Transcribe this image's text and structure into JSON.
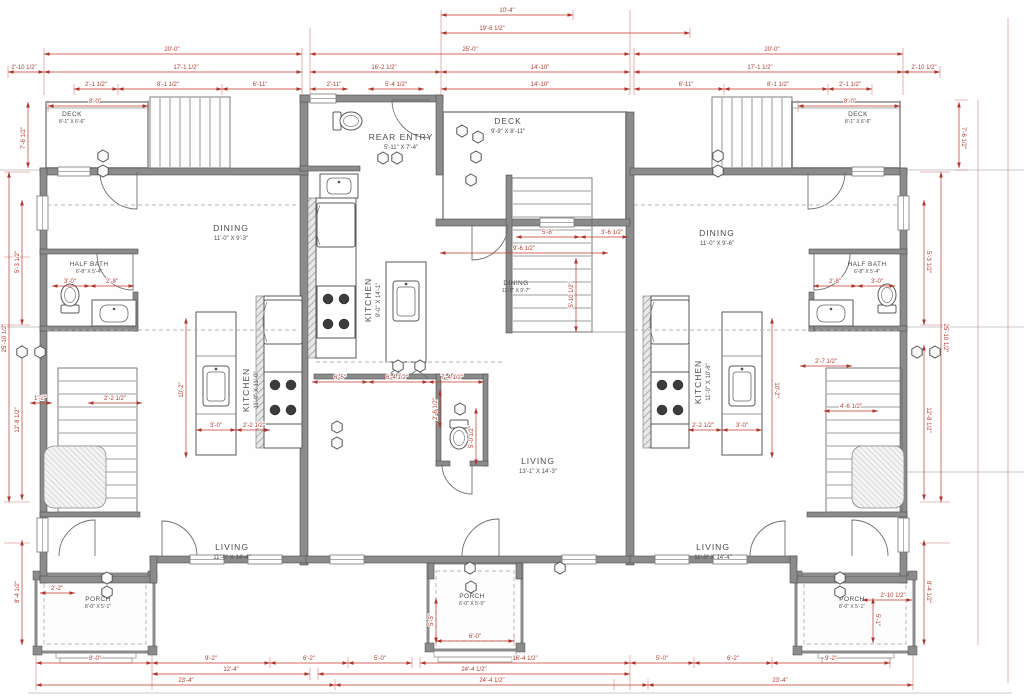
{
  "drawing": {
    "type": "architectural floor plan - triplex main level",
    "colors": {
      "dimension_red": "#c0392b",
      "wall_gray": "#8b8b8b",
      "label_gray": "#4d4d4d",
      "background": "#fefefe"
    }
  },
  "rooms": [
    {
      "id": "left-deck",
      "label": "DECK",
      "size": "8'-1\" X 6'-6\"",
      "x": 72,
      "y": 116,
      "small": true
    },
    {
      "id": "left-dining",
      "label": "DINING",
      "size": "11'-0\" X 9'-3\"",
      "x": 231,
      "y": 231
    },
    {
      "id": "left-kitchen",
      "label": "KITCHEN",
      "size": "11'-0\" X 11'-0\"",
      "x": 249,
      "y": 390,
      "r": -90
    },
    {
      "id": "left-halfbath",
      "label": "HALF BATH",
      "size": "6'-8\" X 5'-4\"",
      "x": 89,
      "y": 266,
      "small": true
    },
    {
      "id": "left-living",
      "label": "LIVING",
      "size": "11'-0\" X 14'-4\"",
      "x": 232,
      "y": 550
    },
    {
      "id": "left-porch",
      "label": "PORCH",
      "size": "8'-0\" X 5'-1\"",
      "x": 98,
      "y": 601,
      "small": true
    },
    {
      "id": "rear-entry",
      "label": "REAR ENTRY",
      "size": "5'-11\" X 7'-4\"",
      "x": 401,
      "y": 140
    },
    {
      "id": "mid-deck",
      "label": "DECK",
      "size": "9'-9\" X 8'-11\"",
      "x": 508,
      "y": 124
    },
    {
      "id": "mid-dining",
      "label": "DINING",
      "size": "11'-5\" X 9'-7\"",
      "x": 516,
      "y": 285,
      "small": true
    },
    {
      "id": "mid-kitchen",
      "label": "KITCHEN",
      "size": "9'-0\" X 14'-1\"",
      "x": 371,
      "y": 300,
      "r": -90
    },
    {
      "id": "mid-living",
      "label": "LIVING",
      "size": "13'-1\" X 14'-3\"",
      "x": 538,
      "y": 464
    },
    {
      "id": "mid-porch",
      "label": "PORCH",
      "size": "6'-0\" X 5'-5\"",
      "x": 472,
      "y": 598,
      "small": true
    },
    {
      "id": "right-dining",
      "label": "DINING",
      "size": "11'-0\" X 9'-6\"",
      "x": 717,
      "y": 236
    },
    {
      "id": "right-kitchen",
      "label": "KITCHEN",
      "size": "11'-0\" X 10'-8\"",
      "x": 701,
      "y": 382,
      "r": -90
    },
    {
      "id": "right-halfbath",
      "label": "HALF BATH",
      "size": "6'-8\" X 5'-4\"",
      "x": 867,
      "y": 266,
      "small": true
    },
    {
      "id": "right-living",
      "label": "LIVING",
      "size": "11'-0\" X 14'-4\"",
      "x": 713,
      "y": 550
    },
    {
      "id": "right-porch",
      "label": "PORCH",
      "size": "8'-0\" X 5'-1\"",
      "x": 852,
      "y": 601,
      "small": true
    },
    {
      "id": "right-deck",
      "label": "DECK",
      "size": "8'-1\" X 6'-6\"",
      "x": 858,
      "y": 116,
      "small": true
    }
  ],
  "dimensions": [
    {
      "t": "10'-4\"",
      "x": 507,
      "y": 12,
      "l": [
        441,
        15,
        573,
        15
      ]
    },
    {
      "t": "19'-6 1/2\"",
      "x": 492,
      "y": 30,
      "l": [
        441,
        33,
        690,
        33
      ]
    },
    {
      "t": "25'-0\"",
      "x": 470,
      "y": 51,
      "l": [
        310,
        54,
        630,
        54
      ]
    },
    {
      "t": "20'-0\"",
      "x": 172,
      "y": 51,
      "l": [
        44,
        54,
        302,
        54
      ]
    },
    {
      "t": "20'-0\"",
      "x": 772,
      "y": 51,
      "l": [
        634,
        54,
        903,
        54
      ]
    },
    {
      "t": "2'-10 1/2\"",
      "x": 24,
      "y": 69,
      "l": [
        8,
        72,
        44,
        72
      ]
    },
    {
      "t": "17'-1 1/2\"",
      "x": 186,
      "y": 69,
      "l": [
        44,
        72,
        302,
        72
      ]
    },
    {
      "t": "17'-1 1/2\"",
      "x": 760,
      "y": 69,
      "l": [
        634,
        72,
        903,
        72
      ]
    },
    {
      "t": "2'-10 1/2\"",
      "x": 924,
      "y": 69,
      "l": [
        903,
        72,
        940,
        72
      ]
    },
    {
      "t": "16'-2 1/2\"",
      "x": 384,
      "y": 69,
      "l": [
        310,
        72,
        441,
        72
      ]
    },
    {
      "t": "14'-10\"",
      "x": 540,
      "y": 69,
      "l": [
        441,
        72,
        630,
        72
      ]
    },
    {
      "t": "14'-10\"",
      "x": 540,
      "y": 86,
      "l": [
        441,
        89,
        630,
        89
      ]
    },
    {
      "t": "2'-1 1/2\"",
      "x": 96,
      "y": 86,
      "l": [
        74,
        89,
        118,
        89
      ]
    },
    {
      "t": "8'-1 1/2\"",
      "x": 168,
      "y": 86,
      "l": [
        118,
        89,
        222,
        89
      ]
    },
    {
      "t": "6'-11\"",
      "x": 260,
      "y": 86,
      "l": [
        222,
        89,
        302,
        89
      ]
    },
    {
      "t": "2'-11\"",
      "x": 334,
      "y": 86,
      "l": [
        310,
        89,
        348,
        89
      ]
    },
    {
      "t": "5'-4 1/2\"",
      "x": 396,
      "y": 86,
      "l": [
        368,
        89,
        424,
        89
      ]
    },
    {
      "t": "6'-11\"",
      "x": 686,
      "y": 86,
      "l": [
        634,
        89,
        724,
        89
      ]
    },
    {
      "t": "8'-1 1/2\"",
      "x": 778,
      "y": 86,
      "l": [
        724,
        89,
        828,
        89
      ]
    },
    {
      "t": "2'-1 1/2\"",
      "x": 850,
      "y": 86,
      "l": [
        828,
        89,
        872,
        89
      ]
    },
    {
      "t": "8'-0\"",
      "x": 95,
      "y": 103,
      "l": [
        48,
        106,
        148,
        106
      ]
    },
    {
      "t": "8'-0\"",
      "x": 850,
      "y": 103,
      "l": [
        798,
        106,
        900,
        106
      ]
    },
    {
      "t": "7'-6 1/2\"",
      "x": 25,
      "y": 138,
      "r": -90,
      "l": [
        28,
        102,
        28,
        168
      ]
    },
    {
      "t": "25'-10 1/2\"",
      "x": 6,
      "y": 338,
      "r": -90,
      "l": [
        9,
        172,
        9,
        502
      ]
    },
    {
      "t": "5'-3 1/2\"",
      "x": 19,
      "y": 262,
      "r": -90,
      "l": [
        22,
        200,
        22,
        325
      ]
    },
    {
      "t": "12'-8 1/2\"",
      "x": 19,
      "y": 420,
      "r": -90,
      "l": [
        22,
        345,
        22,
        500
      ]
    },
    {
      "t": "8'-4 1/2\"",
      "x": 19,
      "y": 592,
      "r": -90,
      "l": [
        22,
        540,
        22,
        645
      ]
    },
    {
      "t": "7'-6 1/2\"",
      "x": 962,
      "y": 138,
      "r": 90,
      "l": [
        959,
        102,
        959,
        168
      ]
    },
    {
      "t": "25'-10 1/2\"",
      "x": 944,
      "y": 338,
      "r": 90,
      "l": [
        941,
        172,
        941,
        502
      ]
    },
    {
      "t": "5'-3 1/2\"",
      "x": 927,
      "y": 262,
      "r": 90,
      "l": [
        924,
        200,
        924,
        325
      ]
    },
    {
      "t": "12'-8 1/2\"",
      "x": 927,
      "y": 420,
      "r": 90,
      "l": [
        924,
        345,
        924,
        500
      ]
    },
    {
      "t": "8'-4 1/2\"",
      "x": 927,
      "y": 592,
      "r": 90,
      "l": [
        924,
        540,
        924,
        645
      ]
    },
    {
      "t": "8'-0\"",
      "x": 95,
      "y": 660,
      "l": [
        36,
        663,
        152,
        663
      ]
    },
    {
      "t": "9'-2\"",
      "x": 211,
      "y": 660,
      "l": [
        152,
        663,
        270,
        663
      ]
    },
    {
      "t": "6'-2\"",
      "x": 309,
      "y": 660,
      "l": [
        270,
        663,
        348,
        663
      ]
    },
    {
      "t": "5'-0\"",
      "x": 380,
      "y": 660,
      "l": [
        348,
        663,
        412,
        663
      ]
    },
    {
      "t": "16'-4 1/2\"",
      "x": 525,
      "y": 660,
      "l": [
        420,
        663,
        630,
        663
      ]
    },
    {
      "t": "5'-0\"",
      "x": 662,
      "y": 660,
      "l": [
        630,
        663,
        694,
        663
      ]
    },
    {
      "t": "6'-2\"",
      "x": 733,
      "y": 660,
      "l": [
        694,
        663,
        772,
        663
      ]
    },
    {
      "t": "9'-2\"",
      "x": 831,
      "y": 660,
      "l": [
        772,
        663,
        890,
        663
      ]
    },
    {
      "t": "12'-4\"",
      "x": 231,
      "y": 671,
      "l": [
        152,
        674,
        310,
        674
      ]
    },
    {
      "t": "24'-4 1/2\"",
      "x": 474,
      "y": 671,
      "l": [
        318,
        674,
        630,
        674
      ]
    },
    {
      "t": "23'-4\"",
      "x": 186,
      "y": 682,
      "l": [
        36,
        685,
        335,
        685
      ]
    },
    {
      "t": "24'-4 1/2\"",
      "x": 492,
      "y": 682,
      "l": [
        335,
        685,
        648,
        685
      ]
    },
    {
      "t": "23'-4\"",
      "x": 780,
      "y": 682,
      "l": [
        648,
        685,
        913,
        685
      ]
    },
    {
      "t": "6'-0\"",
      "x": 475,
      "y": 638,
      "l": [
        436,
        641,
        514,
        641
      ]
    },
    {
      "t": "2'-10 1/2\"",
      "x": 893,
      "y": 597,
      "l": [
        862,
        600,
        912,
        600
      ]
    },
    {
      "t": "2'-2\"",
      "x": 57,
      "y": 590,
      "l": [
        40,
        593,
        75,
        593
      ]
    },
    {
      "t": "9'-6 1/2\"",
      "x": 524,
      "y": 250,
      "l": [
        440,
        253,
        608,
        253
      ]
    },
    {
      "t": "5'-10 1/2\"",
      "x": 573,
      "y": 295,
      "r": -90,
      "l": [
        576,
        258,
        576,
        332
      ]
    },
    {
      "t": "5'-8\"",
      "x": 548,
      "y": 234,
      "l": [
        516,
        237,
        580,
        237
      ]
    },
    {
      "t": "3'-6 1/2\"",
      "x": 612,
      "y": 234,
      "l": [
        580,
        237,
        628,
        237
      ]
    },
    {
      "t": "6'-5\"",
      "x": 340,
      "y": 379,
      "l": [
        312,
        382,
        368,
        382
      ]
    },
    {
      "t": "6'-4 1/2\"",
      "x": 397,
      "y": 379,
      "l": [
        368,
        382,
        428,
        382
      ]
    },
    {
      "t": "7'-4 1/2\"",
      "x": 452,
      "y": 379,
      "l": [
        428,
        382,
        484,
        382
      ]
    },
    {
      "t": "2'-6 1/2\"",
      "x": 437,
      "y": 409,
      "r": -90,
      "l": [
        440,
        390,
        440,
        428
      ]
    },
    {
      "t": "5'-0 1/2\"",
      "x": 473,
      "y": 437,
      "r": -90,
      "l": [
        476,
        408,
        476,
        465
      ]
    },
    {
      "t": "3'-0\"",
      "x": 70,
      "y": 283,
      "l": [
        52,
        286,
        90,
        286
      ]
    },
    {
      "t": "2'-8\"",
      "x": 112,
      "y": 283,
      "l": [
        90,
        286,
        134,
        286
      ]
    },
    {
      "t": "3'-0\"",
      "x": 877,
      "y": 283,
      "l": [
        857,
        286,
        895,
        286
      ]
    },
    {
      "t": "2'-8\"",
      "x": 835,
      "y": 283,
      "l": [
        813,
        286,
        857,
        286
      ]
    },
    {
      "t": "3'-0\"",
      "x": 216,
      "y": 427,
      "l": [
        196,
        430,
        236,
        430
      ]
    },
    {
      "t": "2'-2 1/2\"",
      "x": 254,
      "y": 427,
      "l": [
        236,
        430,
        270,
        430
      ]
    },
    {
      "t": "10'-2\"",
      "x": 183,
      "y": 390,
      "r": -90,
      "l": [
        186,
        318,
        186,
        458
      ]
    },
    {
      "t": "10'-2\"",
      "x": 775,
      "y": 390,
      "r": 90,
      "l": [
        772,
        318,
        772,
        458
      ]
    },
    {
      "t": "2'-2 1/2\"",
      "x": 703,
      "y": 427,
      "l": [
        688,
        430,
        722,
        430
      ]
    },
    {
      "t": "3'-0\"",
      "x": 742,
      "y": 427,
      "l": [
        722,
        430,
        762,
        430
      ]
    },
    {
      "t": "2'-7 1/2\"",
      "x": 826,
      "y": 363,
      "l": [
        800,
        366,
        852,
        366
      ]
    },
    {
      "t": "4'-6 1/2\"",
      "x": 851,
      "y": 408,
      "l": [
        824,
        411,
        878,
        411
      ]
    },
    {
      "t": "2'-2 1/2\"",
      "x": 115,
      "y": 400,
      "l": [
        88,
        403,
        142,
        403
      ]
    },
    {
      "t": "1'-2\"",
      "x": 40,
      "y": 400,
      "l": [
        30,
        403,
        52,
        403
      ]
    },
    {
      "t": "5'-5\"",
      "x": 433,
      "y": 620,
      "r": -90,
      "l": [
        436,
        598,
        436,
        643
      ]
    },
    {
      "t": "5'-1\"",
      "x": 876,
      "y": 620,
      "r": 90,
      "l": [
        873,
        598,
        873,
        643
      ]
    }
  ],
  "keynotes": [
    [
      103,
      156
    ],
    [
      103,
      171
    ],
    [
      718,
      156
    ],
    [
      718,
      171
    ],
    [
      383,
      158
    ],
    [
      397,
      158
    ],
    [
      462,
      131
    ],
    [
      478,
      137
    ],
    [
      476,
      157
    ],
    [
      471,
      180
    ],
    [
      22,
      352
    ],
    [
      40,
      352
    ],
    [
      917,
      352
    ],
    [
      935,
      352
    ],
    [
      107,
      578
    ],
    [
      107,
      592
    ],
    [
      470,
      568
    ],
    [
      560,
      568
    ],
    [
      471,
      587
    ],
    [
      840,
      578
    ],
    [
      840,
      592
    ],
    [
      398,
      366
    ],
    [
      420,
      366
    ],
    [
      337,
      427
    ],
    [
      337,
      443
    ],
    [
      460,
      409
    ]
  ]
}
